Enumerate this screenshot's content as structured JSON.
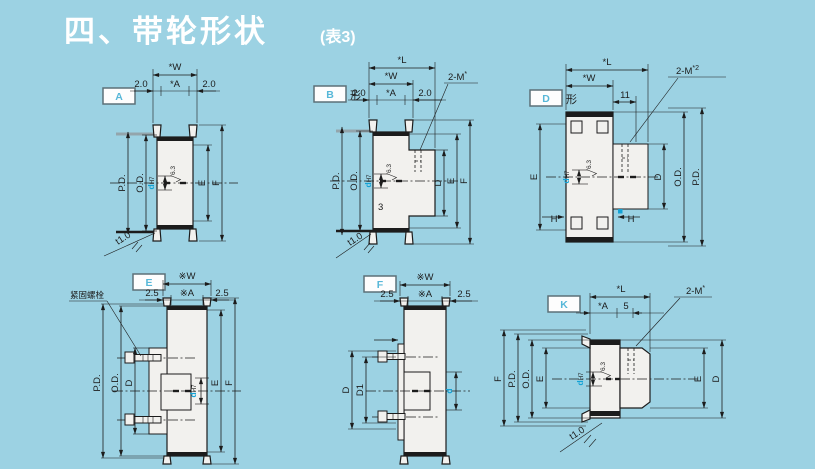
{
  "page": {
    "title": "四、带轮形状",
    "subtitle": "(表3)"
  },
  "colors": {
    "background": "#9cd2e3",
    "line": "#1c1c1c",
    "body_fill": "#f2f1ee",
    "accent_blue": "#14a3d6",
    "label_letter": "#56b7d8",
    "title_text": "#ffffff"
  },
  "diagrams": {
    "A": {
      "label": "A",
      "dims": {
        "W": "*W",
        "pad_left": "2.0",
        "A": "*A",
        "pad_right": "2.0",
        "PD": "P.D.",
        "OD": "O.D.",
        "d": "d",
        "fit": "H7",
        "finish": "6.3",
        "E": "E",
        "F": "F",
        "t": "t1.0"
      }
    },
    "B": {
      "label": "B",
      "suffix": "形",
      "dims": {
        "L": "*L",
        "W": "*W",
        "pad_left": "2.0",
        "A": "*A",
        "pad_right": "2.0",
        "tap": "2-M",
        "tap_sup": "*",
        "PD": "P.D.",
        "OD": "O.D.",
        "d": "d",
        "fit": "H7",
        "finish": "6.3",
        "hub_mark": "3",
        "D": "D",
        "E": "E",
        "F": "F",
        "t": "t1.0"
      }
    },
    "D": {
      "label": "D",
      "suffix": "形",
      "dims": {
        "L": "*L",
        "W": "*W",
        "offset": "11",
        "tap": "2-M",
        "tap_sup": "*2",
        "E": "E",
        "d": "d",
        "fit": "H7",
        "finish": "6.3",
        "D": "D",
        "OD": "O.D.",
        "PD": "P.D.",
        "H_left": "H",
        "H_right": "H"
      }
    },
    "E": {
      "label": "E",
      "callout": "紧固螺栓",
      "dims": {
        "W": "※W",
        "pad_left": "2.5",
        "A": "※A",
        "pad_right": "2.5",
        "PD": "P.D.",
        "OD": "O.D.",
        "D": "D",
        "d": "d",
        "fit": "H7",
        "E": "E",
        "F": "F"
      }
    },
    "F": {
      "label": "F",
      "dims": {
        "W": "※W",
        "pad_left": "2.5",
        "A": "※A",
        "pad_right": "2.5",
        "D": "D",
        "D1": "D1",
        "d": "d"
      }
    },
    "K": {
      "label": "K",
      "dims": {
        "L": "*L",
        "A": "*A",
        "five": "5",
        "tap": "2-M",
        "tap_sup": "*",
        "F": "F",
        "PD": "P.D.",
        "OD": "O.D.",
        "E_left": "E",
        "d": "d",
        "fit": "H7",
        "finish": "6.3",
        "E_right": "E",
        "D": "D",
        "t": "t1.0"
      }
    }
  }
}
